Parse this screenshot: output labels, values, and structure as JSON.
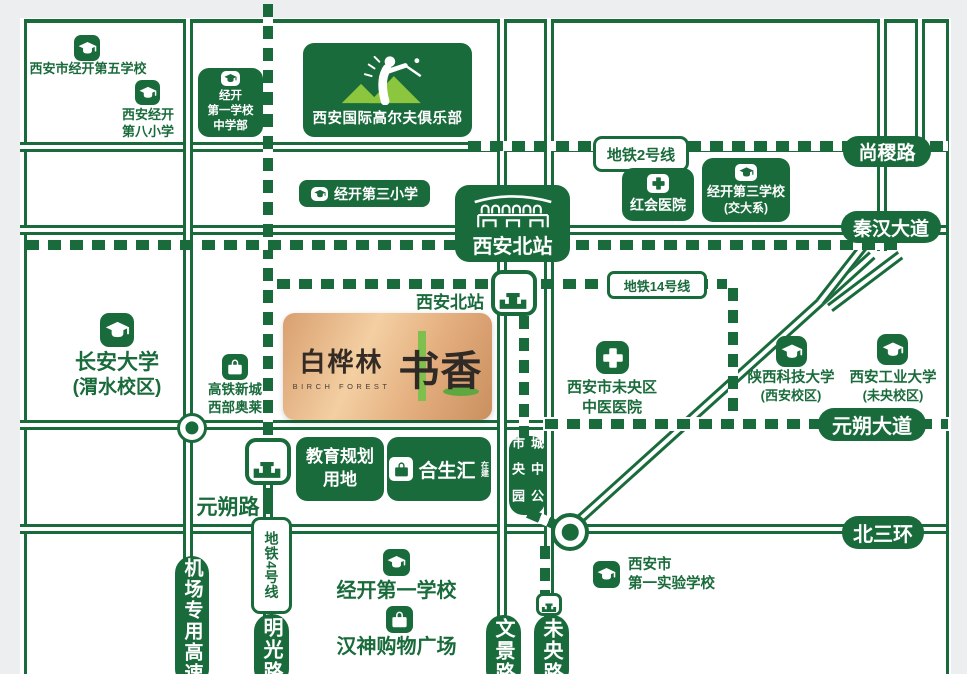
{
  "colors": {
    "map_green": "#1A6B3C",
    "accent_light_green": "#8CC63E",
    "copper_light": "#F3CFA2",
    "copper_dark": "#C98F5F",
    "margin_gray": "#ECEEF0"
  },
  "metro": {
    "line2": "地铁2号线",
    "line14": "地铁14号线",
    "line4": "地铁4号线"
  },
  "roads": {
    "shangji": "尚稷路",
    "qinhan": "秦汉大道",
    "yuanshuo_ave": "元朔大道",
    "yuanshuo_rd": "元朔路",
    "beisanhuan": "北三环",
    "airport": "机场专用高速",
    "mingguang": "明光路",
    "wenjing": "文景路",
    "weiyang": "未央路"
  },
  "stations": {
    "north_badge": "西安北站",
    "north_metro": "西安北站"
  },
  "pois": {
    "school5": "西安市经开第五学校",
    "school8": [
      "西安经开",
      "第八小学"
    ],
    "jk1_mid": [
      "经开",
      "第一学校",
      "中学部"
    ],
    "golf": "西安国际高尔夫俱乐部",
    "honghui": "红会医院",
    "jk3": [
      "经开第三学校",
      "(交大系)"
    ],
    "jk3_pri": "经开第三小学",
    "changan": [
      "长安大学",
      "(渭水校区)"
    ],
    "outlets": [
      "高铁新城",
      "西部奥莱"
    ],
    "tcm": [
      "西安市未央区",
      "中医医院"
    ],
    "sust": [
      "陕西科技大学",
      "(西安校区)"
    ],
    "xatu": [
      "西安工业大学",
      "(未央校区)"
    ],
    "edu": [
      "教育规划",
      "用地"
    ],
    "hesheng": "合生汇",
    "hesheng_tag": "在建",
    "park": [
      "城市",
      "中央",
      "公园"
    ],
    "jk1": "经开第一学校",
    "hanshen": "汉神购物广场",
    "first_exp": [
      "西安市",
      "第一实验学校"
    ]
  },
  "logo": {
    "cn": "白桦林",
    "en": "BIRCH FOREST",
    "shu": "书",
    "xiang": "香"
  }
}
